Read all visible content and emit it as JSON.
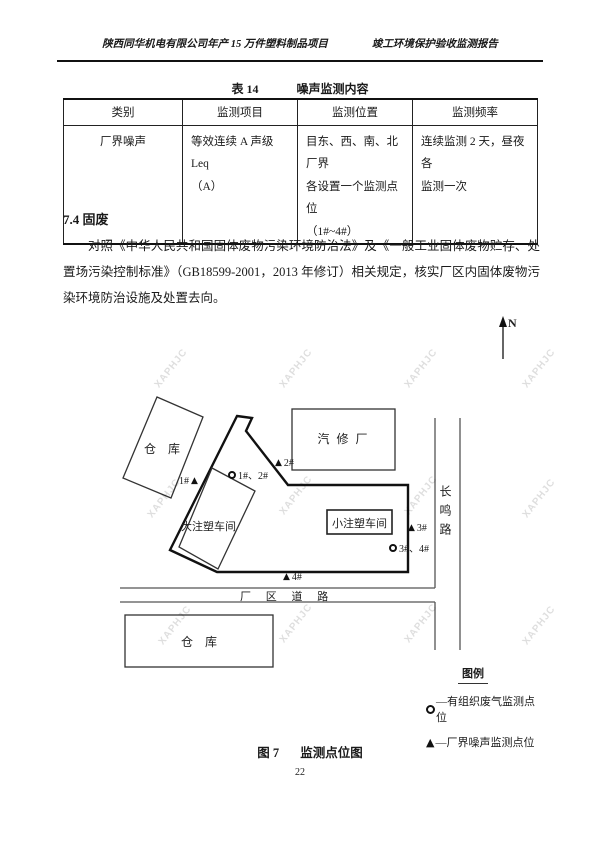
{
  "page": {
    "header_left": "陕西同华机电有限公司年产 15 万件塑料制品项目",
    "header_right": "竣工环境保护验收监测报告",
    "page_number": "22"
  },
  "table": {
    "title_prefix": "表 14",
    "title": "噪声监测内容",
    "headers": [
      "类别",
      "监测项目",
      "监测位置",
      "监测频率"
    ],
    "row": {
      "category": "厂界噪声",
      "project_line1": "等效连续 A 声级 Leq",
      "project_line2": "（A）",
      "location_line1": "目东、西、南、北厂界",
      "location_line2": "各设置一个监测点位",
      "location_line3": "（1#~4#）",
      "frequency_line1": "连续监测 2 天，昼夜各",
      "frequency_line2": "监测一次"
    }
  },
  "section": {
    "heading": "7.4 固废",
    "paragraph": "对照《中华人民共和国固体废物污染环境防治法》及《一般工业固体废物贮存、处置场污染控制标准》（GB18599-2001，2013 年修订）相关规定，核实厂区内固体废物污染环境防治设施及处置去向。"
  },
  "map": {
    "north_label": "N",
    "watermark": "XAPHJC",
    "buildings": {
      "warehouse_top": "仓　库",
      "auto_repair": "汽 修 厂",
      "large_workshop": "大注塑车间",
      "small_workshop": "小注塑车间",
      "warehouse_bottom": "仓　库"
    },
    "roads": {
      "changming": "长鸣路",
      "factory_road": "厂 区 道 路"
    },
    "points": {
      "noise1": "1#",
      "gas12": "1#、2#",
      "noise2": "2#",
      "noise3": "3#",
      "gas34": "3#、4#",
      "noise4": "4#"
    },
    "legend": {
      "title": "图例",
      "gas": "—有组织废气监测点位",
      "noise": "—厂界噪声监测点位"
    }
  },
  "caption": {
    "prefix": "图 7",
    "text": "监测点位图"
  }
}
